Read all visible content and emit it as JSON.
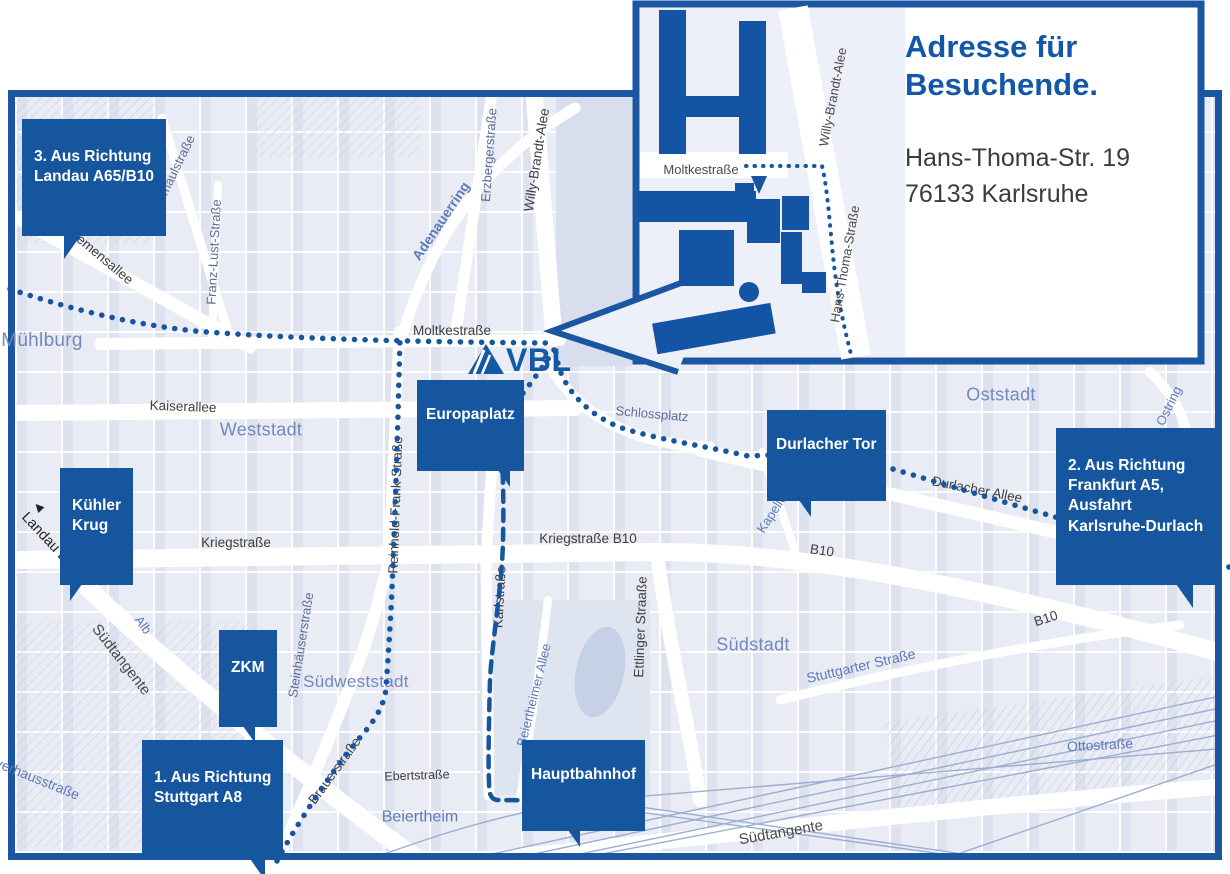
{
  "colors": {
    "accent": "#15569f",
    "border": "#1a56a1",
    "building": "#1355a4",
    "route": "#15569f",
    "district_label": "#7288bd",
    "street_dark": "#3e3e3e",
    "street_blue": "#5d7ab8",
    "map_background": "#e9ecf4"
  },
  "inset": {
    "title": "Adresse für\nBesuchende.",
    "address": "Hans-Thoma-Str. 19\n76133 Karlsruhe",
    "streets": {
      "moltkestrasse": "Moltkestraße",
      "willy_brandt_allee": "Willy-Brandt-Alee",
      "hans_thoma_strasse": "Hans-Thoma-Straße"
    }
  },
  "logo": {
    "vbl": "VBL"
  },
  "callouts": {
    "route3": "3. Aus Richtung\nLandau A65/B10",
    "route2": "2. Aus Richtung\nFrankfurt A5,\nAusfahrt\nKarlsruhe-Durlach",
    "route1": "1. Aus Richtung\nStuttgart A8",
    "kuehler_krug": "Kühler\nKrug",
    "zkm": "ZKM",
    "europaplatz": "Europaplatz",
    "durlacher_tor": "Durlacher Tor",
    "hauptbahnhof": "Hauptbahnhof"
  },
  "districts": {
    "muehlburg": "Mühlburg",
    "weststadt": "Weststadt",
    "oststadt": "Oststadt",
    "suedstadt": "Südstadt",
    "suedweststadt": "Südweststadt"
  },
  "streets": {
    "siemensallee": "Siemensallee",
    "kussmaulstrasse": "Kußmaulstraße",
    "franz_lust_strasse": "Franz-Lust-Straße",
    "erzbergerstrasse": "Erzbergerstraße",
    "willy_brandt_allee": "Willy-Brandt-Alee",
    "adenauerring": "Adenauerring",
    "moltkestrasse": "Moltkestraße",
    "kaiserallee": "Kaiserallee",
    "schlossplatz": "Schlossplatz",
    "reinhold_frank_strasse": "Reinhold-Frank-Straße",
    "kriegstrasse": "Kriegstraße",
    "kriegstrasse_b10": "Kriegstraße B10",
    "b10_mid": "B10",
    "b10_right": "B10",
    "karlstrasse": "Karlstraße",
    "ettlinger_strasse": "Ettlinger Straaße",
    "durlacher_allee": "Durlacher Allee",
    "kapellenstrasse": "Kapellenstraße",
    "ostring_top": "Ostring",
    "ostring_bottom": "Ostring",
    "stuttgarter_strasse": "Stuttgarter Straße",
    "suedtangente_left": "Südtangente",
    "suedtangente_bottom": "Südtangente",
    "steinhaeuserstrasse": "Steinhäuserstraße",
    "brauerstrasse": "Brauerstraße",
    "ebertstrasse": "Ebertstraße",
    "beiertheim": "Beiertheim",
    "beiertheimer_allee": "Beiertheimer Allee",
    "ottostrasse": "Ottostraße",
    "alb": "Alb",
    "pulverhausstrasse": "Pulverhausstraße",
    "landau_b10": "Landau B10"
  },
  "icons": {
    "landau_arrow": "◀"
  }
}
